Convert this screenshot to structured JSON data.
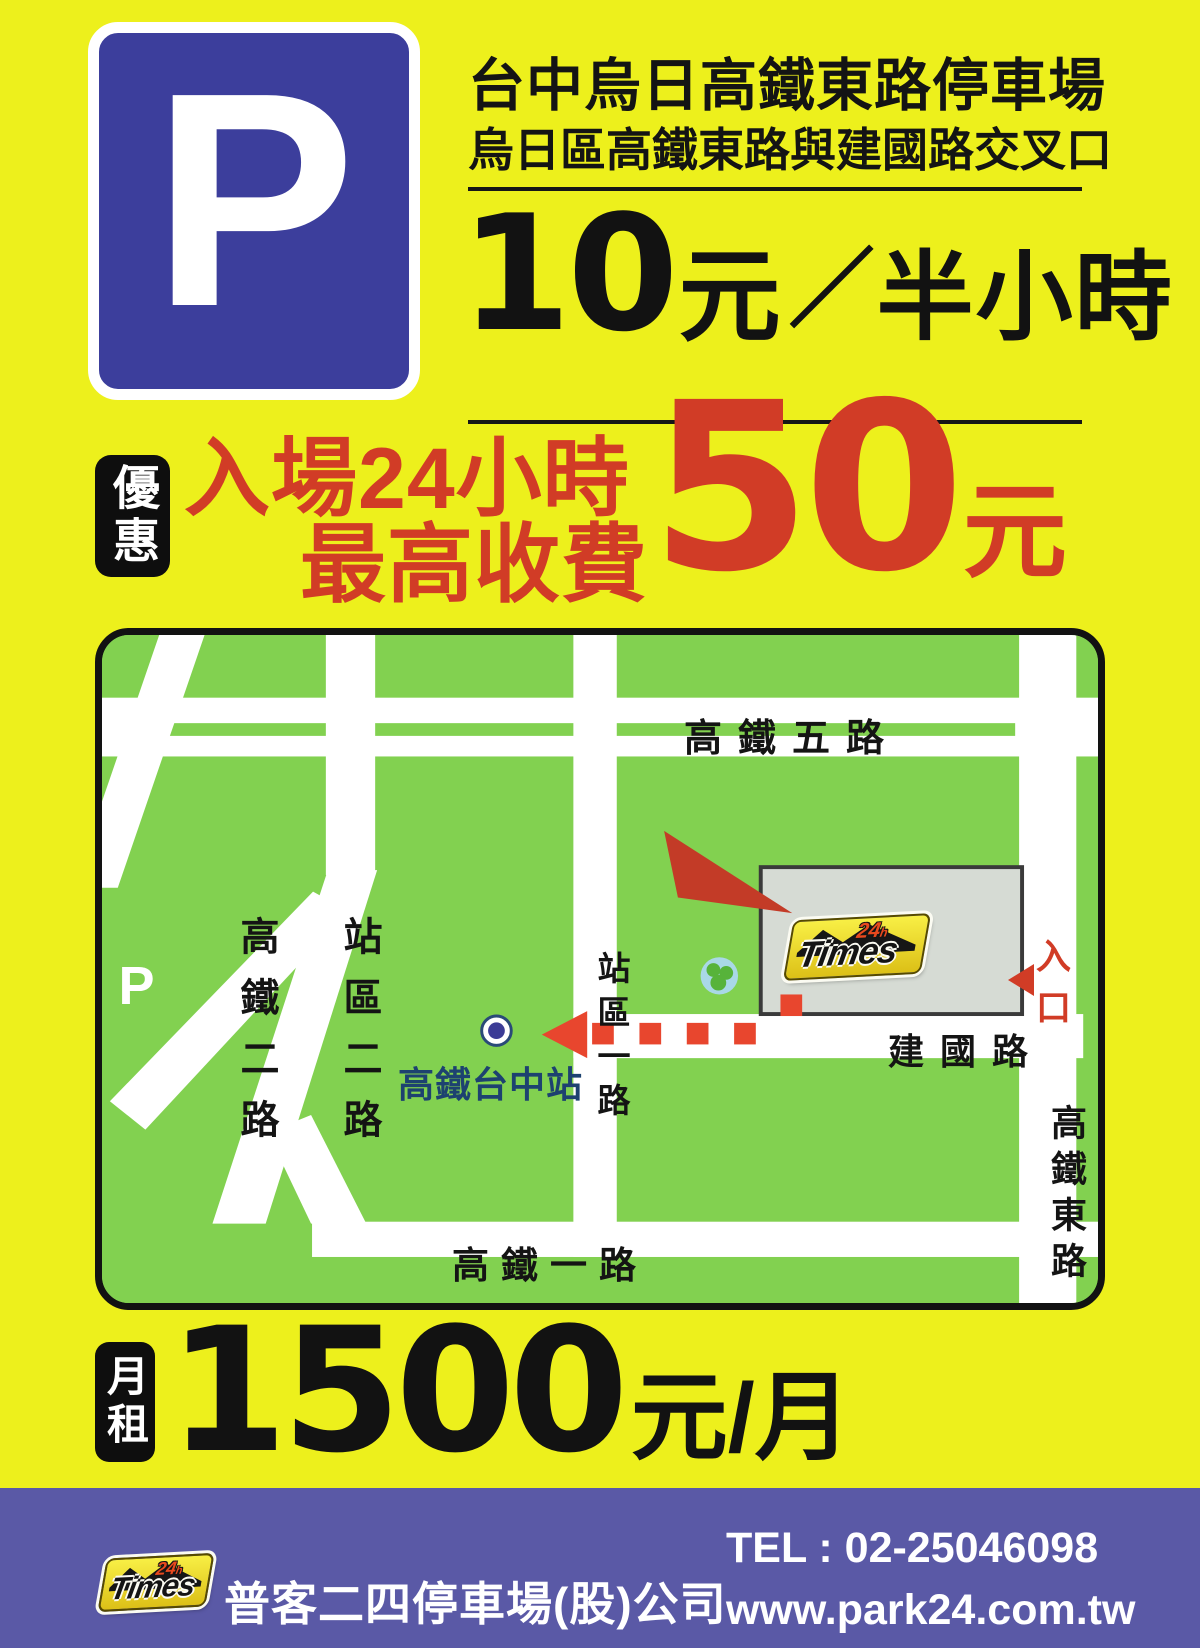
{
  "header": {
    "parking_symbol": "P",
    "title": "台中烏日高鐵東路停車場",
    "subtitle": "烏日區高鐵東路與建國路交叉口",
    "rate": {
      "amount": "10",
      "unit": "元",
      "slash": "／",
      "per": "半小時"
    }
  },
  "promo": {
    "badge": "優惠",
    "line1": "入場24小時",
    "line2": "最高收費",
    "amount": "50",
    "unit": "元"
  },
  "map": {
    "road_labels": {
      "top": "高鐵五路",
      "left": "高鐵二路",
      "station_rd2": "站區二路",
      "station_rd1": "站區一路",
      "bottom": "高鐵一路",
      "east": "高鐵東路",
      "jianguo": "建國路"
    },
    "station_label": "高鐵台中站",
    "bubble": {
      "line1": "入場24小時内",
      "line2": "最高收費",
      "amount": "50",
      "unit": "元"
    },
    "walk_oval": {
      "line1": "高鐵站步行",
      "line2": "3分鐘"
    },
    "entrance_label": "入口",
    "parking_symbol": "P"
  },
  "brand": {
    "name": "Times",
    "hours": "24",
    "hours_suffix": "h"
  },
  "monthly": {
    "badge": "月租",
    "amount": "1500",
    "unit": "元/月"
  },
  "footer": {
    "company": "普客二四停車場(股)公司",
    "tel": "TEL : 02-25046098",
    "website": "www.park24.com.tw"
  },
  "colors": {
    "background_yellow": "#edf01c",
    "accent_red": "#d13c26",
    "bubble_red": "#c33b27",
    "map_green": "#82d150",
    "sign_blue": "#3c3e9c",
    "footer_purple": "#5a59a6",
    "brand_yellow": "#f2dc28"
  }
}
